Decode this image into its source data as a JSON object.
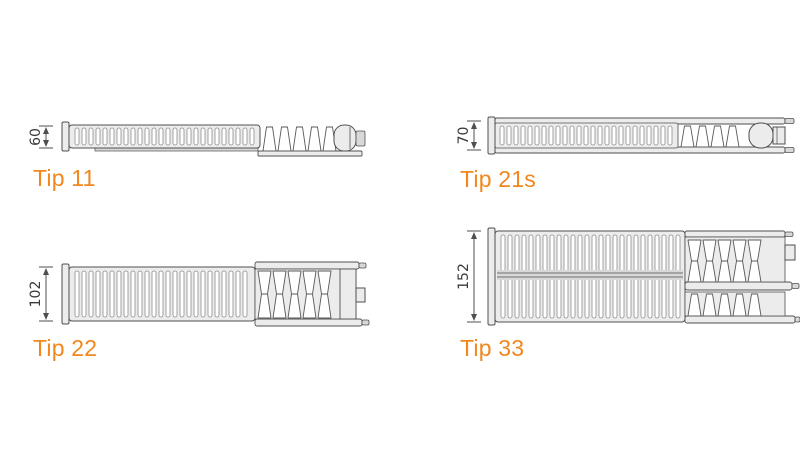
{
  "diagram": {
    "accent_color": "#f1871d",
    "line_color": "#4f4f4f",
    "dimension_text_color": "#3a3a3a",
    "radiators": [
      {
        "id": "tip-11",
        "label": "Tip 11",
        "depth_mm": "60"
      },
      {
        "id": "tip-21s",
        "label": "Tip 21s",
        "depth_mm": "70"
      },
      {
        "id": "tip-22",
        "label": "Tip 22",
        "depth_mm": "102"
      },
      {
        "id": "tip-33",
        "label": "Tip 33",
        "depth_mm": "152"
      }
    ]
  }
}
